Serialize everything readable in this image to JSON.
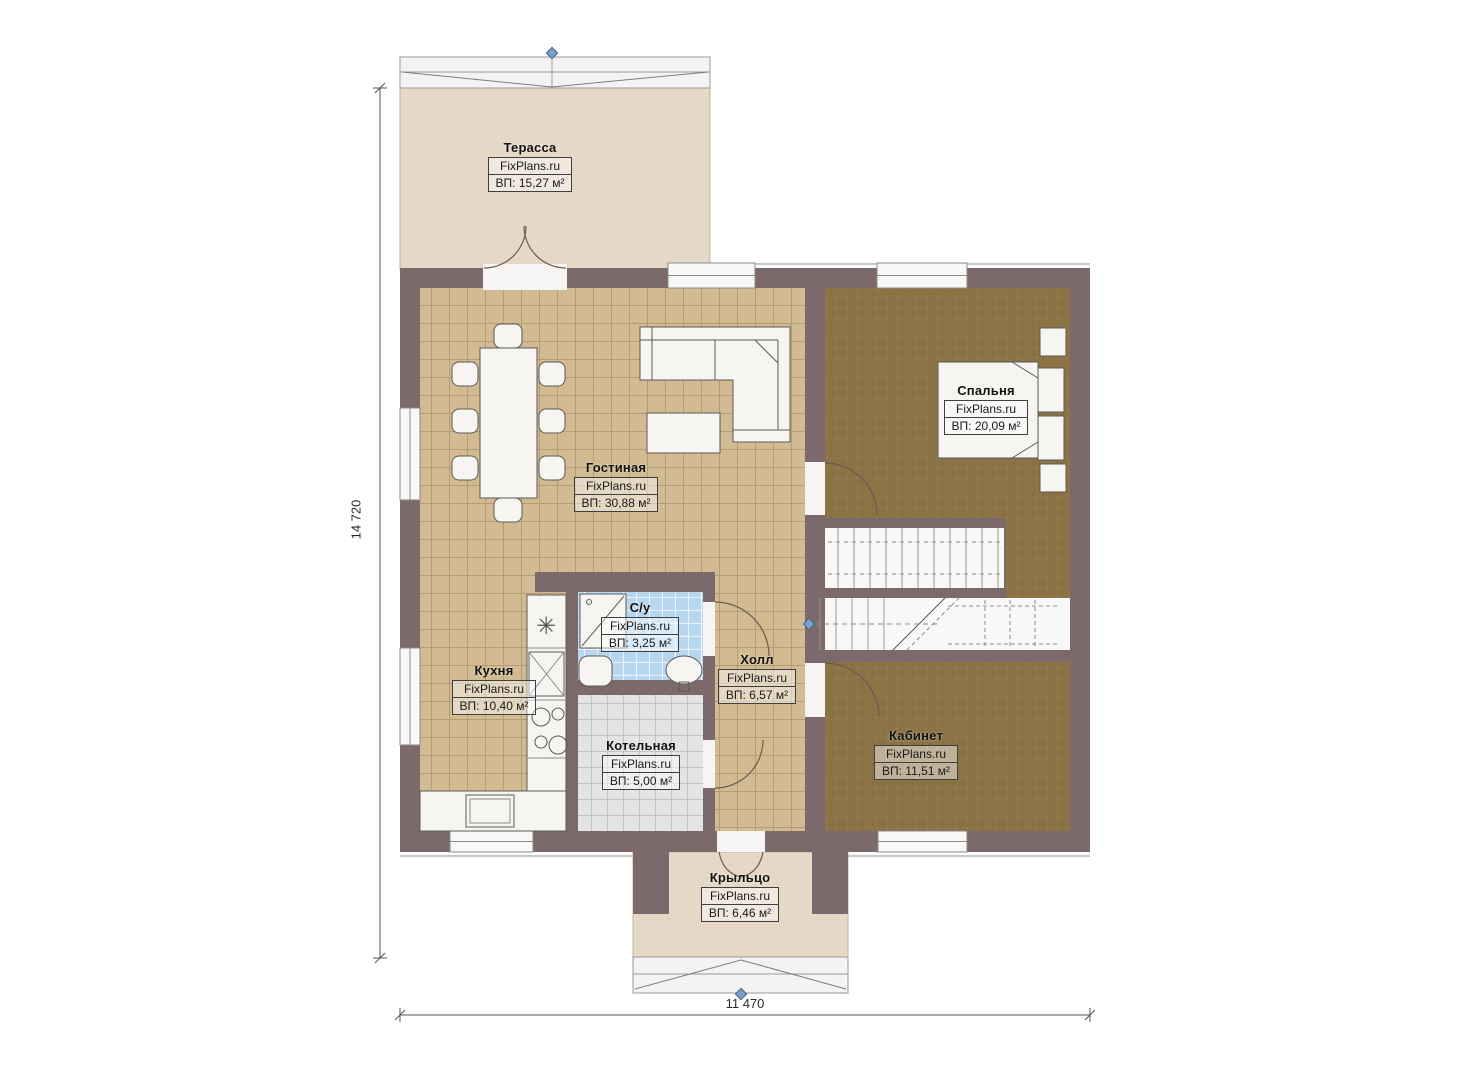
{
  "plan": {
    "title": "floor-plan",
    "brand": "FixPlans.ru",
    "rooms": [
      {
        "id": "terrace",
        "name": "Терасса",
        "brand": "FixPlans.ru",
        "area": "ВП: 15,27 м²"
      },
      {
        "id": "living",
        "name": "Гостиная",
        "brand": "FixPlans.ru",
        "area": "ВП: 30,88 м²"
      },
      {
        "id": "bedroom",
        "name": "Спальня",
        "brand": "FixPlans.ru",
        "area": "ВП: 20,09 м²"
      },
      {
        "id": "kitchen",
        "name": "Кухня",
        "brand": "FixPlans.ru",
        "area": "ВП: 10,40 м²"
      },
      {
        "id": "bathroom",
        "name": "С/у",
        "brand": "FixPlans.ru",
        "area": "ВП: 3,25 м²"
      },
      {
        "id": "hall",
        "name": "Холл",
        "brand": "FixPlans.ru",
        "area": "ВП: 6,57 м²"
      },
      {
        "id": "boiler",
        "name": "Котельная",
        "brand": "FixPlans.ru",
        "area": "ВП: 5,00 м²"
      },
      {
        "id": "office",
        "name": "Кабинет",
        "brand": "FixPlans.ru",
        "area": "ВП: 11,51 м²"
      },
      {
        "id": "porch",
        "name": "Крыльцо",
        "brand": "FixPlans.ru",
        "area": "ВП: 6,46 м²"
      }
    ],
    "dimensions": {
      "height_label": "14 720",
      "width_label": "11 470"
    },
    "colors": {
      "wall": "#7b696b",
      "tile_tan": "#d2bb92",
      "carpet_brown": "#8b7345",
      "tile_blue": "#b7d6f0",
      "tile_gray": "#e4e4e2",
      "deck_beige": "#e6d8c6",
      "marker_blue": "#7ba0c4"
    }
  }
}
